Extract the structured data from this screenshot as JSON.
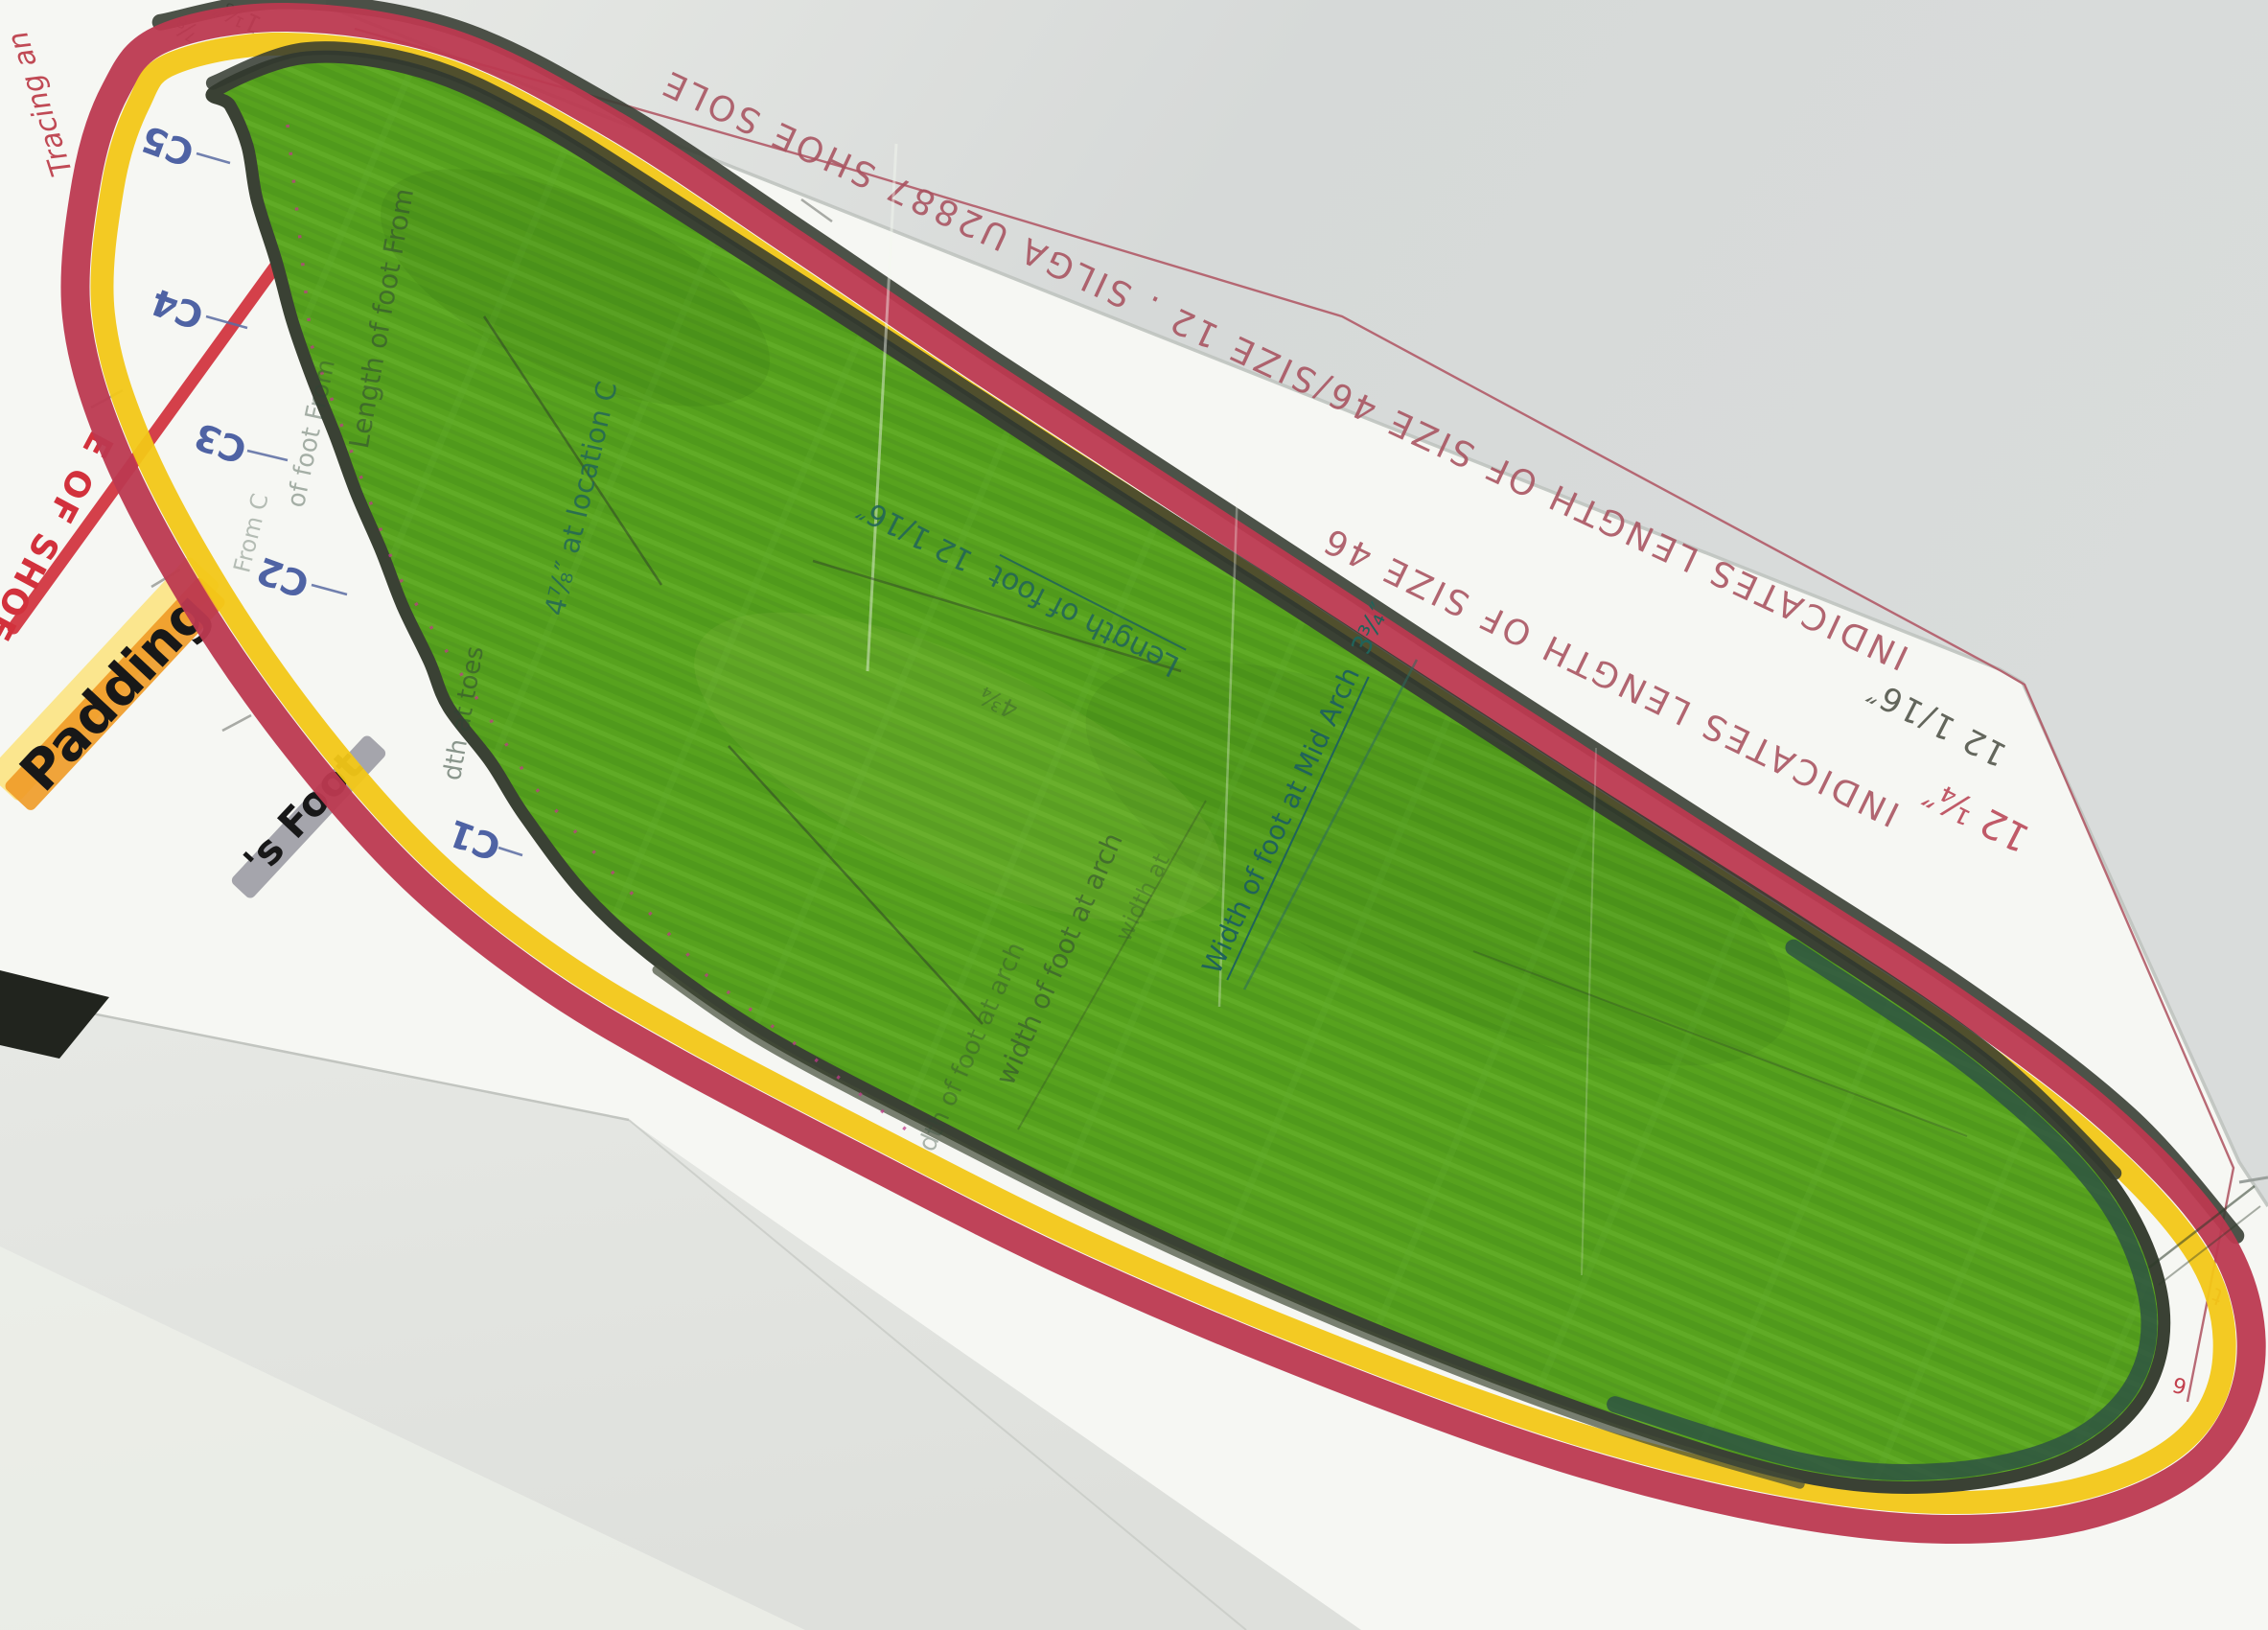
{
  "scan": {
    "edge_text_outer": "INDICATES LENGTH OF SIZE 46/SIZE 12 . SILGA U2887 SHOE SOLE",
    "edge_text_inner": "INDICATES LENGTH OF SIZE 46",
    "edge_measure_pencil": "12 1/16″",
    "edge_measure_red": "12 ¼″",
    "corner_script": "Tracing an",
    "toe_fraction_small": "⅞",
    "toe_fraction_large": "1⅛″",
    "label_shoe_edge": "E OF SHOE",
    "label_padding": "Padding",
    "label_foot": "'s Foot",
    "markers": [
      "C5",
      "C4",
      "C3",
      "C2",
      "C1"
    ],
    "interior": {
      "toe_note_1": "Length of foot From",
      "toe_note_2": "of foot From",
      "toe_note_3": "From C",
      "toes_width_note": "dth at toes",
      "location_note": "4⅞″ at location C",
      "foot_length_label": "Length of foot",
      "foot_length_value": "12 1/16″",
      "ball_note": "4¾",
      "mid_arch_label": "Width of foot at Mid Arch",
      "mid_arch_value": "3¾″",
      "arch_note_1": "width of foot at arch",
      "arch_note_2": "dth of foot at arch",
      "arch_note_3": "width at"
    },
    "stray_marks": {
      "heel_1": "t",
      "heel_2": "6"
    },
    "colors": {
      "foot_green": "#57a21e",
      "sole_red": "#bc3950",
      "band_yellow": "#f2c717",
      "edge_ink_red": "#a8525f",
      "marker_blue": "#4f63a4",
      "highlight_orange": "#f09a26"
    }
  }
}
